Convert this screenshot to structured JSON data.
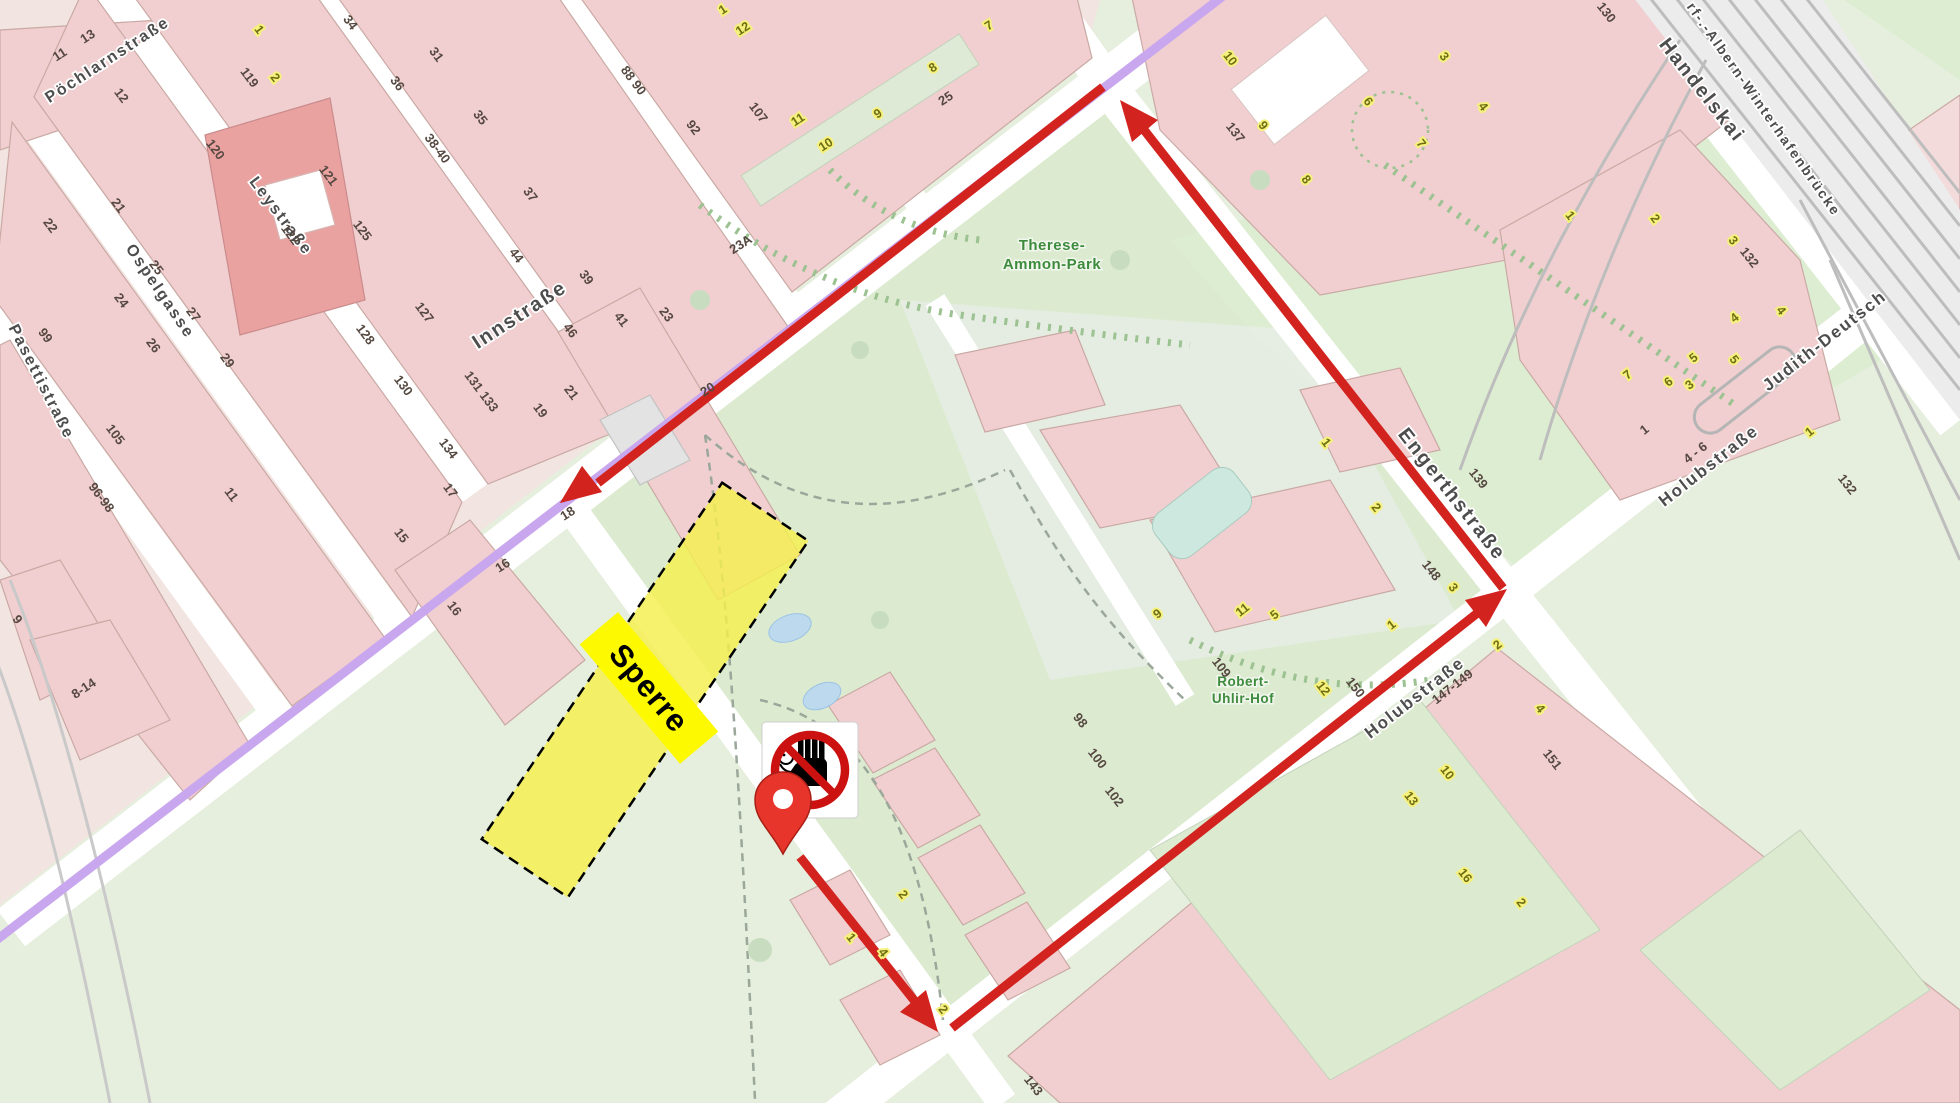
{
  "map": {
    "colors": {
      "route_red": "#d2231e",
      "tram_purple": "#c9a7ee",
      "closure_yellow": "#f5ef4d",
      "closure_label_bg": "#fdf900",
      "building_pink": "#f1cfd0",
      "building_salmon": "#eaa2a1",
      "park_green": "#dcebd0",
      "street_white": "#ffffff",
      "rail_gray": "#bdbdbd",
      "pool_blue": "#cde9df",
      "pond_blue": "#bcd9ee"
    },
    "closure": {
      "label": "Sperre"
    },
    "icons": {
      "pin": "location-pin-icon",
      "no_entry": "no-pedestrians-sign-icon"
    },
    "street_labels": [
      {
        "t": "Pöchlarnstraße",
        "x": 110,
        "y": 64,
        "a": -33,
        "s": 16
      },
      {
        "t": "Leystraße",
        "x": 277,
        "y": 219,
        "a": 53,
        "s": 16
      },
      {
        "t": "Ospelgasse",
        "x": 156,
        "y": 294,
        "a": 56,
        "s": 16
      },
      {
        "t": "Pasettistraße",
        "x": 37,
        "y": 384,
        "a": 63,
        "s": 16
      },
      {
        "t": "Innstraße",
        "x": 523,
        "y": 320,
        "a": -33,
        "s": 20
      },
      {
        "t": "Engerthstraße",
        "x": 1447,
        "y": 498,
        "a": 52,
        "s": 20
      },
      {
        "t": "Holubstraße",
        "x": 1418,
        "y": 702,
        "a": -38,
        "s": 17
      },
      {
        "t": "Holubstraße",
        "x": 1712,
        "y": 470,
        "a": -38,
        "s": 17
      },
      {
        "t": "Handelskai",
        "x": 1697,
        "y": 94,
        "a": 52,
        "s": 20
      },
      {
        "t": "rf-.-Albern-Winterhafenbrücke",
        "x": 1760,
        "y": 112,
        "a": 55,
        "s": 14
      },
      {
        "t": "Judith-Deutsch",
        "x": 1828,
        "y": 345,
        "a": -38,
        "s": 17
      },
      {
        "t": "Therese-",
        "x": 1052,
        "y": 250,
        "a": 0,
        "s": 15,
        "green": true
      },
      {
        "t": "Ammon-Park",
        "x": 1052,
        "y": 269,
        "a": 0,
        "s": 15,
        "green": true
      },
      {
        "t": "Robert-",
        "x": 1243,
        "y": 686,
        "a": 0,
        "s": 13.5,
        "green": true
      },
      {
        "t": "Uhlir-Hof",
        "x": 1243,
        "y": 703,
        "a": 0,
        "s": 13.5,
        "green": true
      }
    ],
    "numbers_dark": [
      {
        "t": "11",
        "x": 62,
        "y": 58,
        "a": -33
      },
      {
        "t": "13",
        "x": 90,
        "y": 40,
        "a": -33
      },
      {
        "t": "12",
        "x": 118,
        "y": 98,
        "a": 53
      },
      {
        "t": "120",
        "x": 212,
        "y": 152,
        "a": 53
      },
      {
        "t": "21",
        "x": 115,
        "y": 208,
        "a": 53
      },
      {
        "t": "22",
        "x": 47,
        "y": 228,
        "a": 53
      },
      {
        "t": "25",
        "x": 153,
        "y": 270,
        "a": 53
      },
      {
        "t": "24",
        "x": 118,
        "y": 303,
        "a": 53
      },
      {
        "t": "27",
        "x": 190,
        "y": 317,
        "a": 53
      },
      {
        "t": "26",
        "x": 150,
        "y": 348,
        "a": 53
      },
      {
        "t": "29",
        "x": 224,
        "y": 363,
        "a": 53
      },
      {
        "t": "119",
        "x": 246,
        "y": 80,
        "a": 53
      },
      {
        "t": "121",
        "x": 325,
        "y": 178,
        "a": 53
      },
      {
        "t": "122",
        "x": 287,
        "y": 237,
        "a": 53
      },
      {
        "t": "125",
        "x": 359,
        "y": 233,
        "a": 53
      },
      {
        "t": "127",
        "x": 421,
        "y": 315,
        "a": 53
      },
      {
        "t": "128",
        "x": 362,
        "y": 337,
        "a": 53
      },
      {
        "t": "130",
        "x": 400,
        "y": 388,
        "a": 53
      },
      {
        "t": "131 133",
        "x": 478,
        "y": 394,
        "a": 53
      },
      {
        "t": "134",
        "x": 445,
        "y": 451,
        "a": 53
      },
      {
        "t": "17",
        "x": 447,
        "y": 493,
        "a": 53
      },
      {
        "t": "15",
        "x": 398,
        "y": 538,
        "a": 53
      },
      {
        "t": "34",
        "x": 347,
        "y": 25,
        "a": 53
      },
      {
        "t": "31",
        "x": 433,
        "y": 57,
        "a": 53
      },
      {
        "t": "36",
        "x": 394,
        "y": 86,
        "a": 53
      },
      {
        "t": "35",
        "x": 477,
        "y": 120,
        "a": 53
      },
      {
        "t": "38-40",
        "x": 434,
        "y": 151,
        "a": 53
      },
      {
        "t": "37",
        "x": 527,
        "y": 197,
        "a": 53
      },
      {
        "t": "44",
        "x": 513,
        "y": 258,
        "a": 53
      },
      {
        "t": "39",
        "x": 583,
        "y": 280,
        "a": 53
      },
      {
        "t": "46",
        "x": 567,
        "y": 333,
        "a": 53
      },
      {
        "t": "41",
        "x": 618,
        "y": 322,
        "a": 53
      },
      {
        "t": "23",
        "x": 663,
        "y": 317,
        "a": 53
      },
      {
        "t": "21",
        "x": 568,
        "y": 395,
        "a": 53
      },
      {
        "t": "19",
        "x": 537,
        "y": 413,
        "a": 53
      },
      {
        "t": "88 90",
        "x": 630,
        "y": 83,
        "a": 53
      },
      {
        "t": "92",
        "x": 690,
        "y": 130,
        "a": 53
      },
      {
        "t": "23A",
        "x": 743,
        "y": 248,
        "a": -33
      },
      {
        "t": "107",
        "x": 755,
        "y": 115,
        "a": 53
      },
      {
        "t": "25",
        "x": 948,
        "y": 102,
        "a": -33
      },
      {
        "t": "20",
        "x": 710,
        "y": 393,
        "a": -33
      },
      {
        "t": "18",
        "x": 570,
        "y": 517,
        "a": -33
      },
      {
        "t": "16",
        "x": 505,
        "y": 569,
        "a": -33
      },
      {
        "t": "16",
        "x": 451,
        "y": 611,
        "a": 53
      },
      {
        "t": "99",
        "x": 42,
        "y": 338,
        "a": 53
      },
      {
        "t": "105",
        "x": 112,
        "y": 437,
        "a": 53
      },
      {
        "t": "96-98",
        "x": 98,
        "y": 500,
        "a": 53
      },
      {
        "t": "11",
        "x": 228,
        "y": 497,
        "a": 53
      },
      {
        "t": "9",
        "x": 14,
        "y": 622,
        "a": 53
      },
      {
        "t": "8-14",
        "x": 86,
        "y": 692,
        "a": -33
      },
      {
        "t": "137",
        "x": 1232,
        "y": 135,
        "a": 52
      },
      {
        "t": "139",
        "x": 1475,
        "y": 481,
        "a": 52
      },
      {
        "t": "148",
        "x": 1428,
        "y": 573,
        "a": 52
      },
      {
        "t": "109",
        "x": 1218,
        "y": 670,
        "a": 52
      },
      {
        "t": "98",
        "x": 1077,
        "y": 723,
        "a": 52
      },
      {
        "t": "100",
        "x": 1094,
        "y": 761,
        "a": 52
      },
      {
        "t": "102",
        "x": 1111,
        "y": 799,
        "a": 52
      },
      {
        "t": "130",
        "x": 1603,
        "y": 15,
        "a": 52
      },
      {
        "t": "132",
        "x": 1746,
        "y": 260,
        "a": 52
      },
      {
        "t": "132",
        "x": 1844,
        "y": 487,
        "a": 52
      },
      {
        "t": "4 - 6",
        "x": 1698,
        "y": 456,
        "a": -38
      },
      {
        "t": "1",
        "x": 1647,
        "y": 433,
        "a": -38
      },
      {
        "t": "150",
        "x": 1352,
        "y": 690,
        "a": 52
      },
      {
        "t": "147-149",
        "x": 1455,
        "y": 690,
        "a": -38
      },
      {
        "t": "151",
        "x": 1549,
        "y": 762,
        "a": 52
      },
      {
        "t": "143",
        "x": 1030,
        "y": 1088,
        "a": 52
      }
    ],
    "numbers_yellow": [
      {
        "t": "1",
        "x": 256,
        "y": 32,
        "a": 53
      },
      {
        "t": "2",
        "x": 272,
        "y": 80,
        "a": 53
      },
      {
        "t": "1",
        "x": 725,
        "y": 13,
        "a": -33
      },
      {
        "t": "12",
        "x": 745,
        "y": 32,
        "a": -33
      },
      {
        "t": "7",
        "x": 991,
        "y": 29,
        "a": -33
      },
      {
        "t": "11",
        "x": 800,
        "y": 123,
        "a": -33
      },
      {
        "t": "10",
        "x": 828,
        "y": 148,
        "a": -33
      },
      {
        "t": "9",
        "x": 880,
        "y": 117,
        "a": -33
      },
      {
        "t": "8",
        "x": 935,
        "y": 71,
        "a": -33
      },
      {
        "t": "10",
        "x": 1227,
        "y": 61,
        "a": 52
      },
      {
        "t": "9",
        "x": 1260,
        "y": 128,
        "a": 52
      },
      {
        "t": "8",
        "x": 1303,
        "y": 182,
        "a": 52
      },
      {
        "t": "6",
        "x": 1365,
        "y": 104,
        "a": 52
      },
      {
        "t": "3",
        "x": 1441,
        "y": 59,
        "a": 52
      },
      {
        "t": "7",
        "x": 1418,
        "y": 146,
        "a": 52
      },
      {
        "t": "4",
        "x": 1480,
        "y": 109,
        "a": 52
      },
      {
        "t": "1",
        "x": 1323,
        "y": 445,
        "a": 52
      },
      {
        "t": "2",
        "x": 1373,
        "y": 510,
        "a": 52
      },
      {
        "t": "3",
        "x": 1450,
        "y": 590,
        "a": 52
      },
      {
        "t": "11",
        "x": 1245,
        "y": 613,
        "a": -38
      },
      {
        "t": "12",
        "x": 1320,
        "y": 691,
        "a": 52
      },
      {
        "t": "10",
        "x": 1444,
        "y": 775,
        "a": 52
      },
      {
        "t": "13",
        "x": 1408,
        "y": 801,
        "a": 52
      },
      {
        "t": "4",
        "x": 1537,
        "y": 711,
        "a": 52
      },
      {
        "t": "7",
        "x": 1630,
        "y": 378,
        "a": -38
      },
      {
        "t": "6",
        "x": 1671,
        "y": 385,
        "a": -38
      },
      {
        "t": "5",
        "x": 1696,
        "y": 361,
        "a": -38
      },
      {
        "t": "3",
        "x": 1692,
        "y": 388,
        "a": -38
      },
      {
        "t": "4",
        "x": 1737,
        "y": 321,
        "a": -38
      },
      {
        "t": "1",
        "x": 1812,
        "y": 435,
        "a": -38
      },
      {
        "t": "1",
        "x": 1567,
        "y": 218,
        "a": 52
      },
      {
        "t": "2",
        "x": 1652,
        "y": 221,
        "a": 52
      },
      {
        "t": "3",
        "x": 1730,
        "y": 243,
        "a": 52
      },
      {
        "t": "4",
        "x": 1778,
        "y": 313,
        "a": 52
      },
      {
        "t": "5",
        "x": 1731,
        "y": 362,
        "a": 52
      },
      {
        "t": "2",
        "x": 900,
        "y": 897,
        "a": 52
      },
      {
        "t": "1",
        "x": 848,
        "y": 940,
        "a": 52
      },
      {
        "t": "4",
        "x": 880,
        "y": 955,
        "a": 52
      },
      {
        "t": "2",
        "x": 940,
        "y": 1012,
        "a": 52
      },
      {
        "t": "1",
        "x": 1394,
        "y": 628,
        "a": -38
      },
      {
        "t": "5",
        "x": 1277,
        "y": 618,
        "a": -38
      },
      {
        "t": "9",
        "x": 1160,
        "y": 617,
        "a": -38
      },
      {
        "t": "2",
        "x": 1500,
        "y": 648,
        "a": -38
      },
      {
        "t": "16",
        "x": 1462,
        "y": 878,
        "a": 52
      },
      {
        "t": "2",
        "x": 1518,
        "y": 905,
        "a": 52
      }
    ]
  }
}
